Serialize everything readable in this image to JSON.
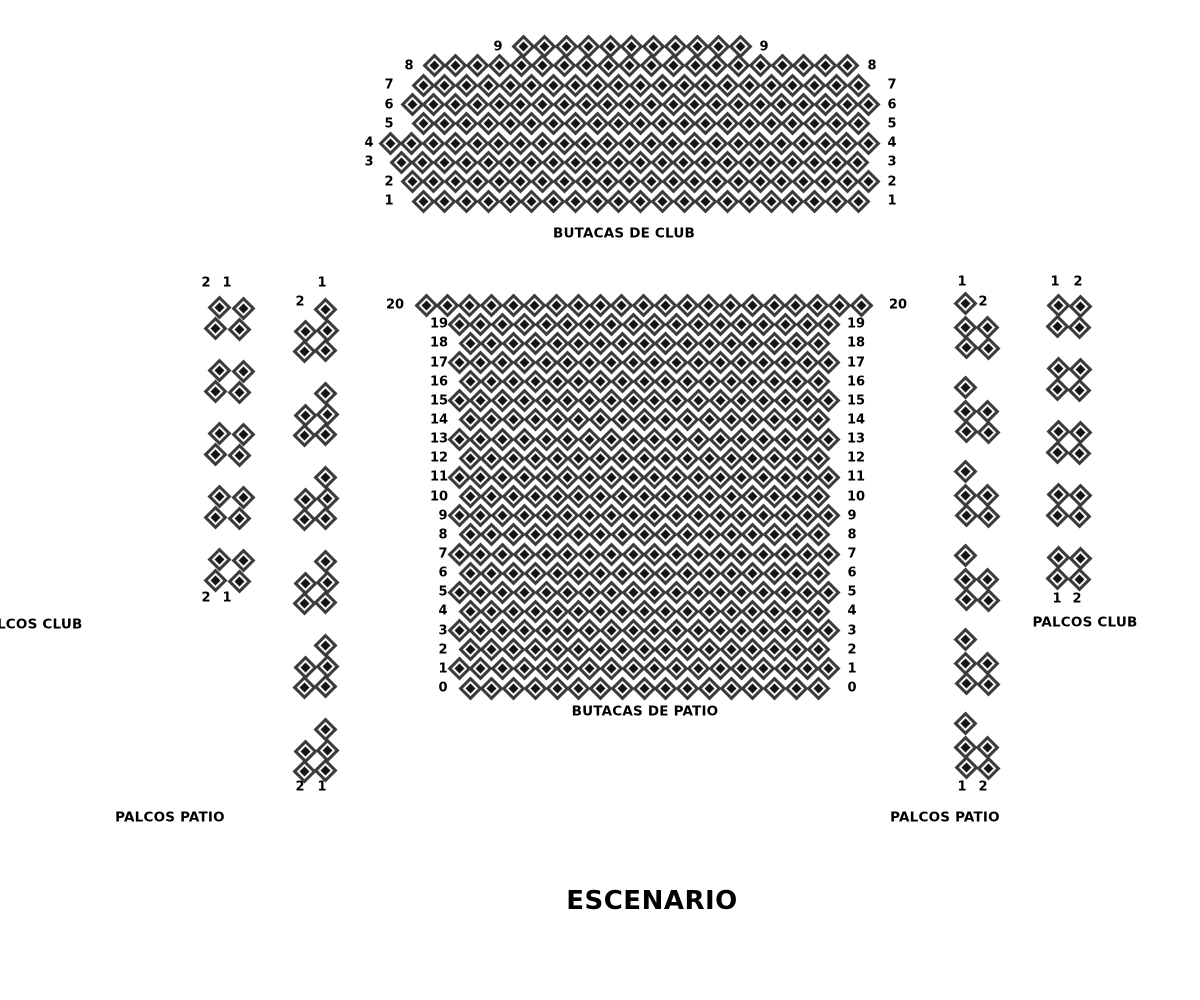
{
  "stage": {
    "label": "ESCENARIO",
    "x": 652,
    "y": 901
  },
  "captions": {
    "club_section": {
      "text": "BUTACAS DE CLUB",
      "x": 624,
      "y": 234
    },
    "patio_section": {
      "text": "BUTACAS DE PATIO",
      "x": 645,
      "y": 712
    },
    "palcos_club_left": {
      "text": "PALCOS CLUB",
      "x": 30,
      "y": 625
    },
    "palcos_club_right": {
      "text": "PALCOS CLUB",
      "x": 1085,
      "y": 623
    },
    "palcos_patio_left": {
      "text": "PALCOS PATIO",
      "x": 170,
      "y": 818
    },
    "palcos_patio_right": {
      "text": "PALCOS PATIO",
      "x": 945,
      "y": 818
    }
  },
  "seat_style": {
    "body_color": "#3b3b3b",
    "ring_color": "#f7f7f7",
    "center_color": "#151515",
    "diamond_size": 24
  },
  "sections": {
    "club": {
      "name": "BUTACAS DE CLUB",
      "seat_dx": 21.75,
      "rows": [
        {
          "num": "9",
          "y": 46.6,
          "x": 523,
          "count": 11,
          "label_left_x": 498,
          "label_right_x": 764
        },
        {
          "num": "8",
          "y": 65.9,
          "x": 434,
          "count": 20,
          "label_left_x": 409,
          "label_right_x": 872
        },
        {
          "num": "7",
          "y": 85.2,
          "x": 423,
          "count": 21,
          "label_left_x": 389,
          "label_right_x": 892
        },
        {
          "num": "6",
          "y": 104.5,
          "x": 412,
          "count": 22,
          "label_left_x": 389,
          "label_right_x": 892
        },
        {
          "num": "5",
          "y": 123.8,
          "x": 423,
          "count": 21,
          "label_left_x": 389,
          "label_right_x": 892
        },
        {
          "num": "4",
          "y": 143.1,
          "x": 390,
          "count": 23,
          "label_left_x": 369,
          "label_right_x": 892
        },
        {
          "num": "3",
          "y": 162.4,
          "x": 401,
          "count": 22,
          "label_left_x": 369,
          "label_right_x": 892
        },
        {
          "num": "2",
          "y": 181.7,
          "x": 412,
          "count": 22,
          "label_left_x": 389,
          "label_right_x": 892
        },
        {
          "num": "1",
          "y": 201.0,
          "x": 423,
          "count": 21,
          "label_left_x": 389,
          "label_right_x": 892
        }
      ]
    },
    "patio": {
      "name": "BUTACAS DE PATIO",
      "seat_dx": 21.75,
      "rows": [
        {
          "num": "20",
          "y": 305.0,
          "x": 426,
          "count": 21,
          "label_left_x": 395,
          "label_right_x": 898
        },
        {
          "num": "19",
          "y": 324.2,
          "x": 459,
          "count": 18,
          "label_left_x": 439,
          "label_right_x": 856
        },
        {
          "num": "18",
          "y": 343.3,
          "x": 470,
          "count": 17,
          "label_left_x": 439,
          "label_right_x": 856
        },
        {
          "num": "17",
          "y": 362.5,
          "x": 459,
          "count": 18,
          "label_left_x": 439,
          "label_right_x": 856
        },
        {
          "num": "16",
          "y": 381.6,
          "x": 470,
          "count": 17,
          "label_left_x": 439,
          "label_right_x": 856
        },
        {
          "num": "15",
          "y": 400.8,
          "x": 459,
          "count": 18,
          "label_left_x": 439,
          "label_right_x": 856
        },
        {
          "num": "14",
          "y": 419.9,
          "x": 470,
          "count": 17,
          "label_left_x": 439,
          "label_right_x": 856
        },
        {
          "num": "13",
          "y": 439.1,
          "x": 459,
          "count": 18,
          "label_left_x": 439,
          "label_right_x": 856
        },
        {
          "num": "12",
          "y": 458.2,
          "x": 470,
          "count": 17,
          "label_left_x": 439,
          "label_right_x": 856
        },
        {
          "num": "11",
          "y": 477.4,
          "x": 459,
          "count": 18,
          "label_left_x": 439,
          "label_right_x": 856
        },
        {
          "num": "10",
          "y": 496.5,
          "x": 470,
          "count": 17,
          "label_left_x": 439,
          "label_right_x": 856
        },
        {
          "num": "9",
          "y": 515.7,
          "x": 459,
          "count": 18,
          "label_left_x": 443,
          "label_right_x": 852
        },
        {
          "num": "8",
          "y": 534.8,
          "x": 470,
          "count": 17,
          "label_left_x": 443,
          "label_right_x": 852
        },
        {
          "num": "7",
          "y": 554.0,
          "x": 459,
          "count": 18,
          "label_left_x": 443,
          "label_right_x": 852
        },
        {
          "num": "6",
          "y": 573.1,
          "x": 470,
          "count": 17,
          "label_left_x": 443,
          "label_right_x": 852
        },
        {
          "num": "5",
          "y": 592.3,
          "x": 459,
          "count": 18,
          "label_left_x": 443,
          "label_right_x": 852
        },
        {
          "num": "4",
          "y": 611.4,
          "x": 470,
          "count": 17,
          "label_left_x": 443,
          "label_right_x": 852
        },
        {
          "num": "3",
          "y": 630.6,
          "x": 459,
          "count": 18,
          "label_left_x": 443,
          "label_right_x": 852
        },
        {
          "num": "2",
          "y": 649.7,
          "x": 470,
          "count": 17,
          "label_left_x": 443,
          "label_right_x": 852
        },
        {
          "num": "1",
          "y": 668.9,
          "x": 459,
          "count": 18,
          "label_left_x": 443,
          "label_right_x": 852
        },
        {
          "num": "0",
          "y": 688.0,
          "x": 470,
          "count": 17,
          "label_left_x": 443,
          "label_right_x": 852
        }
      ]
    }
  },
  "palcos": {
    "patterns": {
      "quad_left": [
        [
          0,
          0
        ],
        [
          24,
          1
        ],
        [
          -4,
          21
        ],
        [
          20,
          22
        ]
      ],
      "quad_right": [
        [
          0,
          0
        ],
        [
          22,
          1
        ],
        [
          -1,
          21
        ],
        [
          21,
          22
        ]
      ],
      "penta_left": [
        [
          20,
          0
        ],
        [
          0,
          22
        ],
        [
          22,
          21
        ],
        [
          -1,
          42
        ],
        [
          20,
          41
        ]
      ],
      "penta_right": [
        [
          0,
          0
        ],
        [
          0,
          24
        ],
        [
          22,
          24
        ],
        [
          1,
          44
        ],
        [
          23,
          45
        ]
      ]
    },
    "columns": [
      {
        "id": "palcos-club-left",
        "pattern": "quad_left",
        "boxes": [
          [
            219,
            307
          ],
          [
            219,
            370
          ],
          [
            219,
            433
          ],
          [
            219,
            496
          ],
          [
            219,
            559
          ]
        ]
      },
      {
        "id": "palcos-patio-left",
        "pattern": "penta_left",
        "boxes": [
          [
            305,
            309
          ],
          [
            305,
            393
          ],
          [
            305,
            477
          ],
          [
            305,
            561
          ],
          [
            305,
            645
          ],
          [
            305,
            729
          ]
        ]
      },
      {
        "id": "palcos-patio-right",
        "pattern": "penta_right",
        "boxes": [
          [
            965,
            303
          ],
          [
            965,
            387
          ],
          [
            965,
            471
          ],
          [
            965,
            555
          ],
          [
            965,
            639
          ],
          [
            965,
            723
          ]
        ]
      },
      {
        "id": "palcos-club-right",
        "pattern": "quad_right",
        "boxes": [
          [
            1058,
            305
          ],
          [
            1058,
            368
          ],
          [
            1058,
            431
          ],
          [
            1058,
            494
          ],
          [
            1058,
            557
          ]
        ]
      }
    ],
    "labels": [
      {
        "text": "2",
        "x": 206,
        "y": 283
      },
      {
        "text": "1",
        "x": 227,
        "y": 283
      },
      {
        "text": "2",
        "x": 206,
        "y": 598
      },
      {
        "text": "1",
        "x": 227,
        "y": 598
      },
      {
        "text": "1",
        "x": 322,
        "y": 283
      },
      {
        "text": "2",
        "x": 300,
        "y": 302
      },
      {
        "text": "2",
        "x": 300,
        "y": 787
      },
      {
        "text": "1",
        "x": 322,
        "y": 787
      },
      {
        "text": "1",
        "x": 962,
        "y": 282
      },
      {
        "text": "2",
        "x": 983,
        "y": 302
      },
      {
        "text": "1",
        "x": 962,
        "y": 787
      },
      {
        "text": "2",
        "x": 983,
        "y": 787
      },
      {
        "text": "1",
        "x": 1055,
        "y": 282
      },
      {
        "text": "2",
        "x": 1078,
        "y": 282
      },
      {
        "text": "1",
        "x": 1057,
        "y": 599
      },
      {
        "text": "2",
        "x": 1077,
        "y": 599
      }
    ]
  }
}
